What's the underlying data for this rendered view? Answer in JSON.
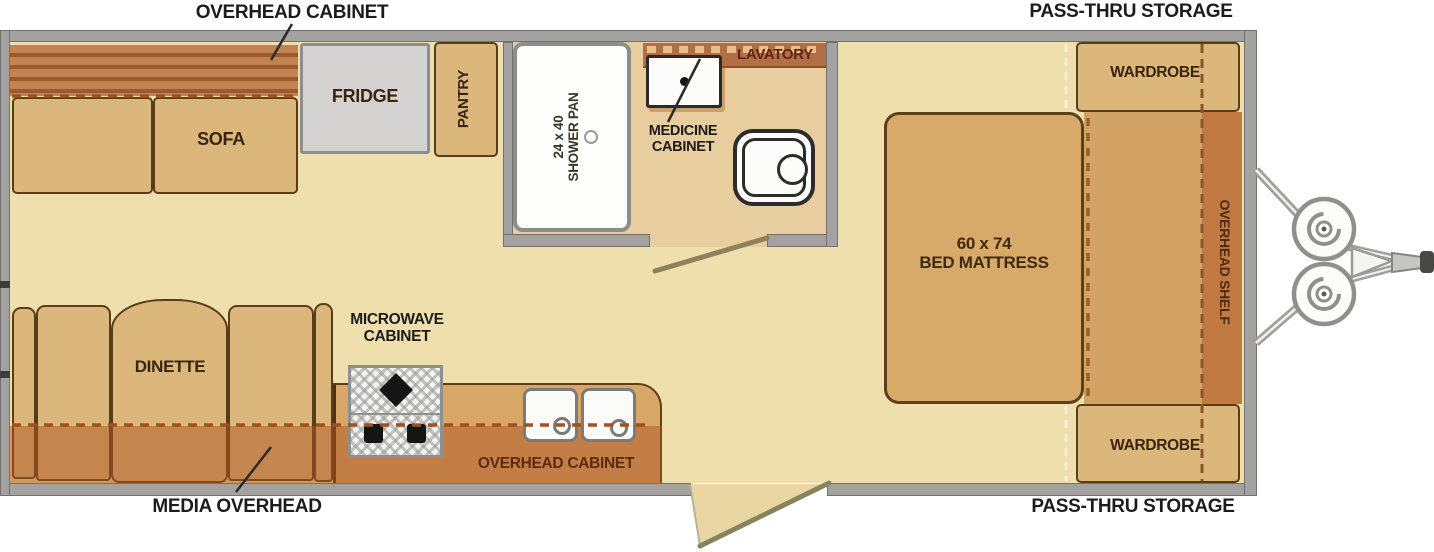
{
  "exterior_labels": {
    "overhead_cabinet": "OVERHEAD CABINET",
    "pass_thru_storage_top": "PASS-THRU STORAGE",
    "pass_thru_storage_bottom": "PASS-THRU STORAGE",
    "media_overhead": "MEDIA OVERHEAD"
  },
  "living_area": {
    "sofa": "SOFA",
    "dinette": "DINETTE"
  },
  "kitchen": {
    "fridge": "FRIDGE",
    "pantry": "PANTRY",
    "microwave_cabinet": {
      "line1": "MICROWAVE",
      "line2": "CABINET"
    },
    "overhead_cabinet": "OVERHEAD CABINET"
  },
  "bathroom": {
    "shower": {
      "size": "24 x 40",
      "name": "SHOWER PAN"
    },
    "medicine_cabinet": {
      "line1": "MEDICINE",
      "line2": "CABINET"
    },
    "lavatory": "LAVATORY"
  },
  "bedroom": {
    "bed": {
      "size": "60 x 74",
      "name": "BED MATTRESS"
    },
    "wardrobe_top": "WARDROBE",
    "wardrobe_bottom": "WARDROBE",
    "overhead_shelf": "OVERHEAD SHELF"
  },
  "colors": {
    "floor": "#efdfad",
    "bathroom_floor": "#e8cd9e",
    "furniture_tan": "#dcb77c",
    "bed_tan": "#d7aa6a",
    "cabinet_orange": "#c07a42",
    "band_overlay": "#ac5620",
    "wall_gray": "#a3a2a0",
    "fridge_gray": "#d4d3d1",
    "label_black": "#1c1c1c",
    "label_brown": "#38240f",
    "label_rust": "#5d2a12"
  }
}
